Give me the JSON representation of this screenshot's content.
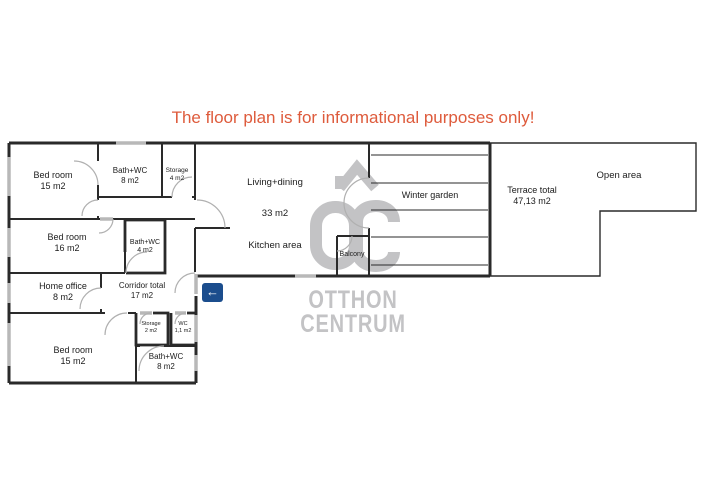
{
  "disclaimer": "The floor plan is for informational purposes only!",
  "watermark": {
    "brand_top": "OTTHON",
    "brand_bottom": "CENTRUM",
    "monogram": "OC"
  },
  "colors": {
    "disclaimer_text": "#DE5B3C",
    "wall": "#2a2a2a",
    "window": "#b8b8b8",
    "door_arc": "#b0b0b0",
    "watermark_gray": "#c3c3c5",
    "entrance_blue": "#1b4d8d"
  },
  "rooms": {
    "bedroom_top": {
      "name": "Bed room",
      "area": "15 m2"
    },
    "bath_top": {
      "name": "Bath+WC",
      "area": "8 m2"
    },
    "storage_top": {
      "name": "Storage",
      "area": "4 m2"
    },
    "living": {
      "name": "Living+dining",
      "area": "33 m2"
    },
    "kitchen": {
      "name": "Kitchen area"
    },
    "winter_garden": {
      "name": "Winter garden"
    },
    "terrace": {
      "name": "Terrace total",
      "area": "47,13 m2"
    },
    "open_area": {
      "name": "Open area"
    },
    "bedroom_mid": {
      "name": "Bed room",
      "area": "16 m2"
    },
    "bath_mid": {
      "name": "Bath+WC",
      "area": "4 m2"
    },
    "home_office": {
      "name": "Home office",
      "area": "8 m2"
    },
    "corridor": {
      "name": "Corridor total",
      "area": "17 m2"
    },
    "storage_small": {
      "name": "Storage",
      "area": "2 m2"
    },
    "wc": {
      "name": "WC",
      "area": "1,1 m2"
    },
    "bedroom_bottom": {
      "name": "Bed room",
      "area": "15 m2"
    },
    "bath_bottom": {
      "name": "Bath+WC",
      "area": "8 m2"
    },
    "balcony": {
      "name": "Balcony"
    }
  },
  "entrance": {
    "icon": "left-arrow",
    "glyph": "←"
  }
}
